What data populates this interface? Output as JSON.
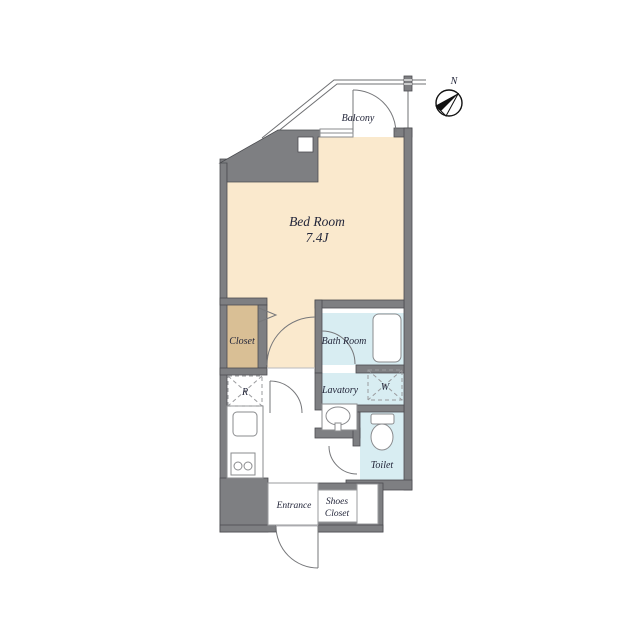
{
  "plan": {
    "rooms": {
      "bedroom": {
        "label": "Bed Room",
        "size": "7.4J"
      },
      "balcony": {
        "label": "Balcony"
      },
      "closet": {
        "label": "Closet"
      },
      "bathroom": {
        "label": "Bath Room"
      },
      "lavatory": {
        "label": "Lavatory"
      },
      "toilet": {
        "label": "Toilet"
      },
      "entrance": {
        "label": "Entrance"
      },
      "shoes_closet": {
        "label_line1": "Shoes",
        "label_line2": "Closet"
      }
    },
    "appliances": {
      "refrigerator_mark": "R",
      "washer_mark": "W"
    },
    "compass": {
      "north_label": "N"
    },
    "colors": {
      "floor_cream": "#fae9cd",
      "closet_tan": "#d9bf95",
      "wet_blue": "#d8edf2",
      "wall_gray": "#7e7f82",
      "white": "#ffffff"
    }
  }
}
